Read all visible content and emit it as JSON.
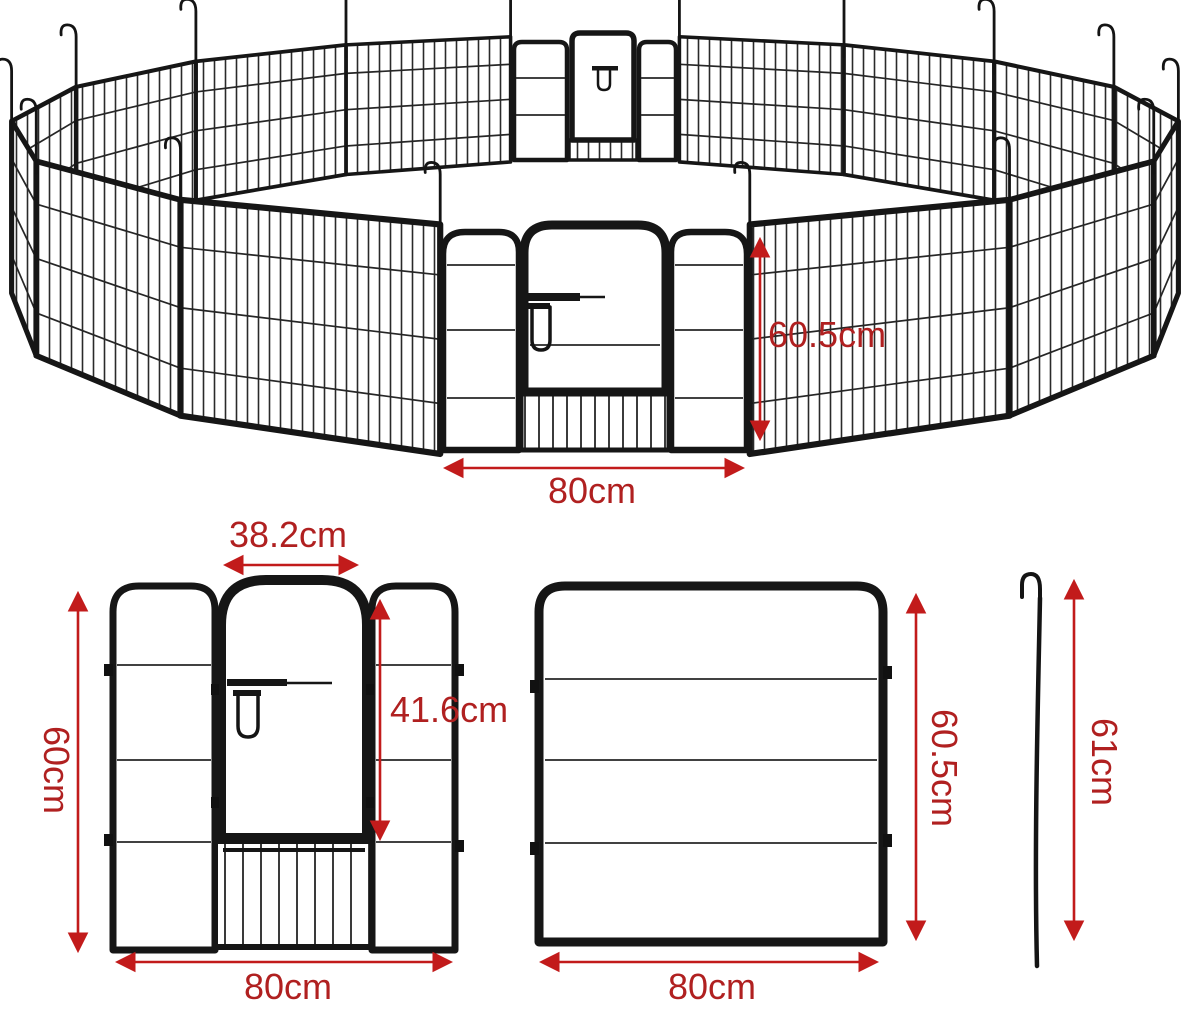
{
  "colors": {
    "dimension_red": "#c21b1b",
    "dimension_text_red": "#b02020",
    "frame_black": "#161616"
  },
  "assembled_pen": {
    "panel_height_label": "60.5cm",
    "panel_width_label": "80cm"
  },
  "door_panel": {
    "door_width_label": "38.2cm",
    "height_label": "60cm",
    "door_height_label": "41.6cm",
    "width_label": "80cm"
  },
  "plain_panel": {
    "height_label": "60.5cm",
    "width_label": "80cm"
  },
  "ground_stake": {
    "height_label": "61cm"
  }
}
